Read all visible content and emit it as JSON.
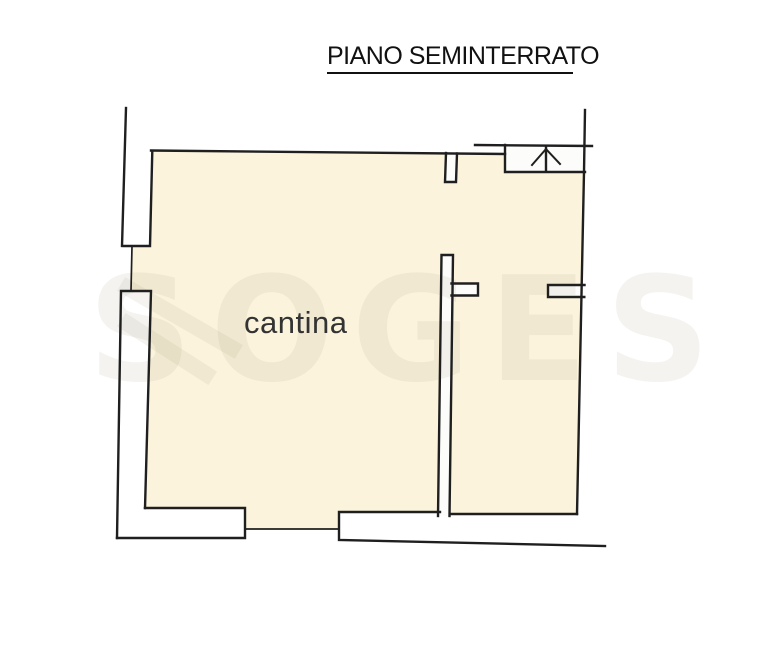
{
  "title": {
    "text": "PIANO SEMINTERRATO"
  },
  "floor_plan": {
    "room_label": "cantina",
    "stairs_icon": "up-arrow",
    "watermark": "SOGES"
  },
  "colors": {
    "floor": "#FBF3DC",
    "line": "#1f1f1f",
    "wall-fill": "#FCFCFA",
    "watermark": "rgba(150,138,112,0.10)",
    "label": "#333333",
    "title": "#111111",
    "page": "#ffffff"
  }
}
